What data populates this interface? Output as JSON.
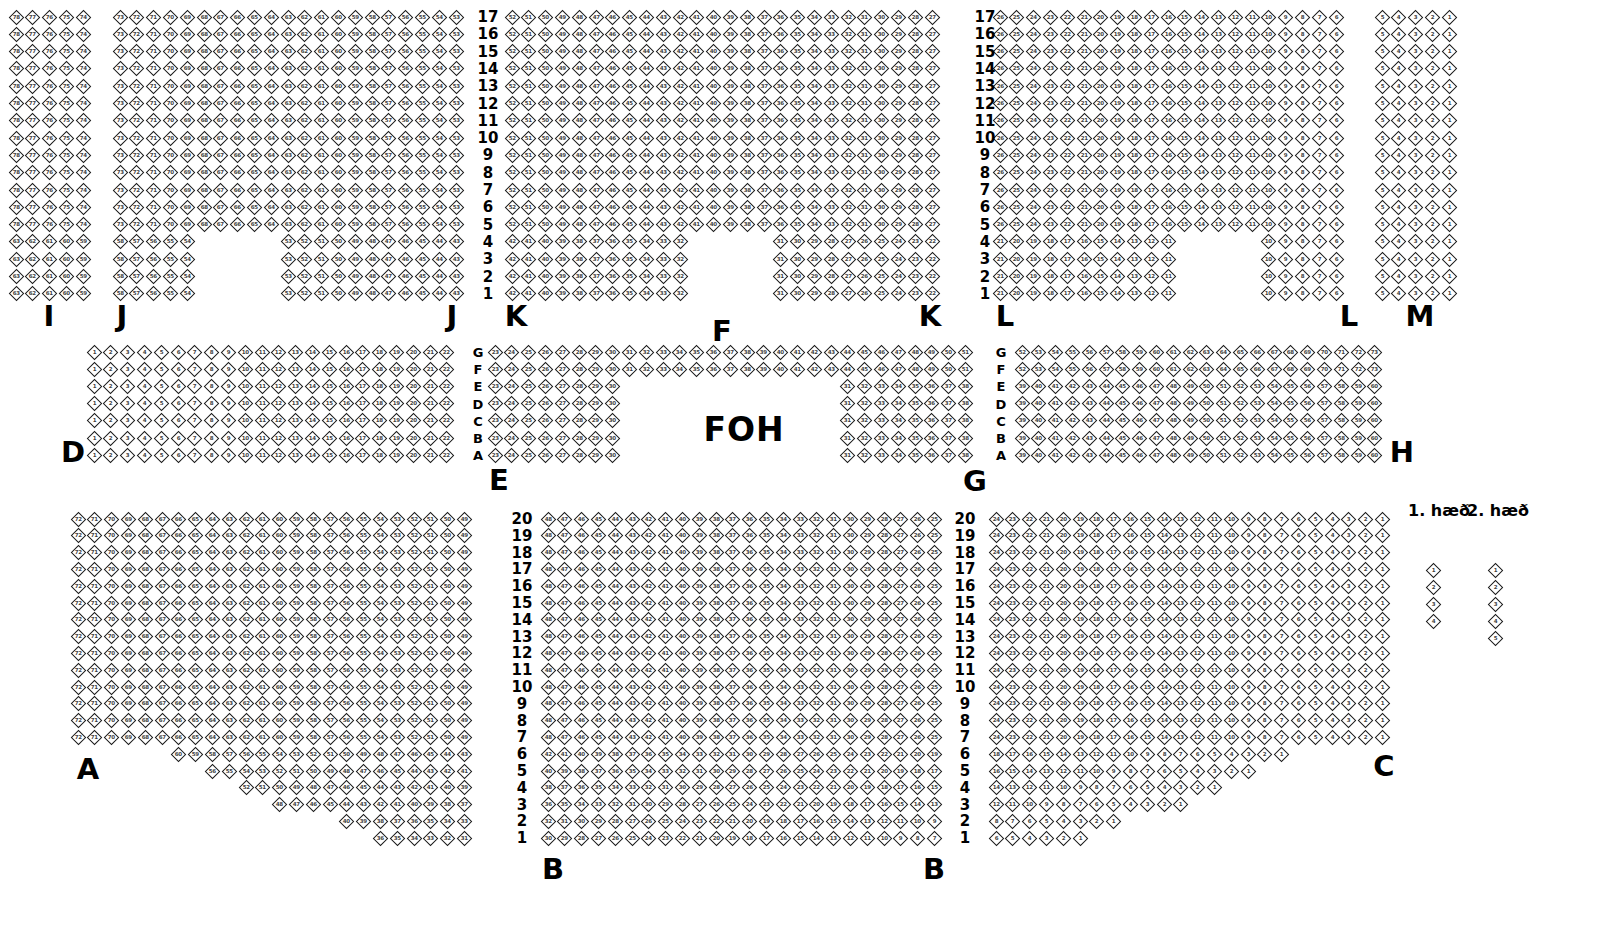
{
  "foh": {
    "text": "FOH",
    "x": 744,
    "y": 429
  },
  "legend": {
    "labels": [
      {
        "text": "1. h\u00e6\u00f0",
        "x": 1439,
        "y": 511
      },
      {
        "text": "2. h\u00e6\u00f0",
        "x": 1498,
        "y": 511
      }
    ],
    "seat_columns": [
      {
        "x": 1433,
        "first_y": 570,
        "count": 4
      },
      {
        "x": 1495,
        "first_y": 570,
        "count": 5
      }
    ],
    "row_pitch": 17
  },
  "seat_map": {
    "colors": {
      "seat_fill": "#ffffff",
      "seat_border": "#1b1b1b",
      "seat_number": "#3f3f3f",
      "label": "#000000"
    },
    "bands": [
      {
        "name": "balcony",
        "numbering": "rtl",
        "marker_style": "number",
        "first_row_y": 17,
        "row_pitch": 17.3,
        "col_pitch": 16.8,
        "row_names": [
          "17",
          "16",
          "15",
          "14",
          "13",
          "12",
          "11",
          "10",
          "9",
          "8",
          "7",
          "6",
          "5",
          "4",
          "3",
          "2",
          "1"
        ],
        "marker_columns": [
          488,
          985
        ],
        "sections": [
          {
            "name": "I",
            "x": 16,
            "cols": 5,
            "labels": [
              {
                "text": "I",
                "x": 49,
                "y": 316
              }
            ]
          },
          {
            "name": "J",
            "x": 120,
            "cols": 21,
            "labels": [
              {
                "text": "J",
                "x": 122,
                "y": 316
              },
              {
                "text": "J",
                "x": 452,
                "y": 316
              }
            ],
            "cutouts": [
              {
                "row_names": [
                  "4",
                  "3",
                  "2",
                  "1"
                ],
                "col_start": 6,
                "col_end": 10
              }
            ]
          },
          {
            "name": "K",
            "x": 512,
            "cols": 26,
            "labels": [
              {
                "text": "K",
                "x": 516,
                "y": 316
              },
              {
                "text": "K",
                "x": 930,
                "y": 316
              }
            ],
            "cutouts": [
              {
                "row_names": [
                  "4",
                  "3",
                  "2",
                  "1"
                ],
                "col_start": 12,
                "col_end": 16
              }
            ]
          },
          {
            "name": "L",
            "x": 1000,
            "cols": 21,
            "labels": [
              {
                "text": "L",
                "x": 1005,
                "y": 316
              },
              {
                "text": "L",
                "x": 1349,
                "y": 316
              }
            ],
            "cutouts": [
              {
                "row_names": [
                  "4",
                  "3",
                  "2",
                  "1"
                ],
                "col_start": 12,
                "col_end": 16
              }
            ]
          },
          {
            "name": "M",
            "x": 1382,
            "cols": 5,
            "labels": [
              {
                "text": "M",
                "x": 1420,
                "y": 316
              }
            ]
          }
        ]
      },
      {
        "name": "mezzanine",
        "numbering": "ltr",
        "marker_style": "letter",
        "first_row_y": 352,
        "row_pitch": 17.2,
        "col_pitch": 16.8,
        "row_names": [
          "G",
          "F",
          "E",
          "D",
          "C",
          "B",
          "A"
        ],
        "marker_columns": [
          478,
          1001
        ],
        "sections": [
          {
            "name": "D",
            "x": 94,
            "cols": 22,
            "labels": [
              {
                "text": "D",
                "x": 73,
                "y": 452
              }
            ]
          },
          {
            "name": "EFG",
            "x": 495,
            "cols": 29,
            "labels": [
              {
                "text": "E",
                "x": 499,
                "y": 480
              },
              {
                "text": "F",
                "x": 722,
                "y": 331
              },
              {
                "text": "G",
                "x": 975,
                "y": 481
              }
            ],
            "row_col_ranges": {
              "G": [
                [
                  1,
                  29
                ]
              ],
              "F": [
                [
                  1,
                  29
                ]
              ],
              "E": [
                [
                  1,
                  8
                ],
                [
                  22,
                  29
                ]
              ],
              "D": [
                [
                  1,
                  8
                ],
                [
                  22,
                  29
                ]
              ],
              "C": [
                [
                  1,
                  8
                ],
                [
                  22,
                  29
                ]
              ],
              "B": [
                [
                  1,
                  8
                ],
                [
                  22,
                  29
                ]
              ],
              "A": [
                [
                  1,
                  8
                ],
                [
                  22,
                  29
                ]
              ]
            }
          },
          {
            "name": "H",
            "x": 1022,
            "cols": 22,
            "labels": [
              {
                "text": "H",
                "x": 1402,
                "y": 452
              }
            ]
          }
        ]
      },
      {
        "name": "floor",
        "numbering": "rtl",
        "marker_style": "number",
        "first_row_y": 519,
        "row_pitch": 16.8,
        "col_pitch": 16.8,
        "row_names": [
          "20",
          "19",
          "18",
          "17",
          "16",
          "15",
          "14",
          "13",
          "12",
          "11",
          "10",
          "9",
          "8",
          "7",
          "6",
          "5",
          "4",
          "3",
          "2",
          "1"
        ],
        "marker_columns": [
          522,
          965
        ],
        "sections": [
          {
            "name": "A",
            "x": 78,
            "cols": 24,
            "labels": [
              {
                "text": "A",
                "x": 88,
                "y": 769
              }
            ],
            "row_start_cols": {
              "6": 7,
              "5": 9,
              "4": 11,
              "3": 13,
              "2": 17,
              "1": 19
            }
          },
          {
            "name": "B",
            "x": 548,
            "cols": 24,
            "labels": [
              {
                "text": "B",
                "x": 553,
                "y": 869
              },
              {
                "text": "B",
                "x": 934,
                "y": 869
              }
            ]
          },
          {
            "name": "C",
            "x": 996,
            "cols": 24,
            "labels": [
              {
                "text": "C",
                "x": 1384,
                "y": 766
              }
            ],
            "row_end_cols": {
              "6": 18,
              "5": 16,
              "4": 14,
              "3": 12,
              "2": 8,
              "1": 6
            }
          }
        ]
      }
    ]
  }
}
